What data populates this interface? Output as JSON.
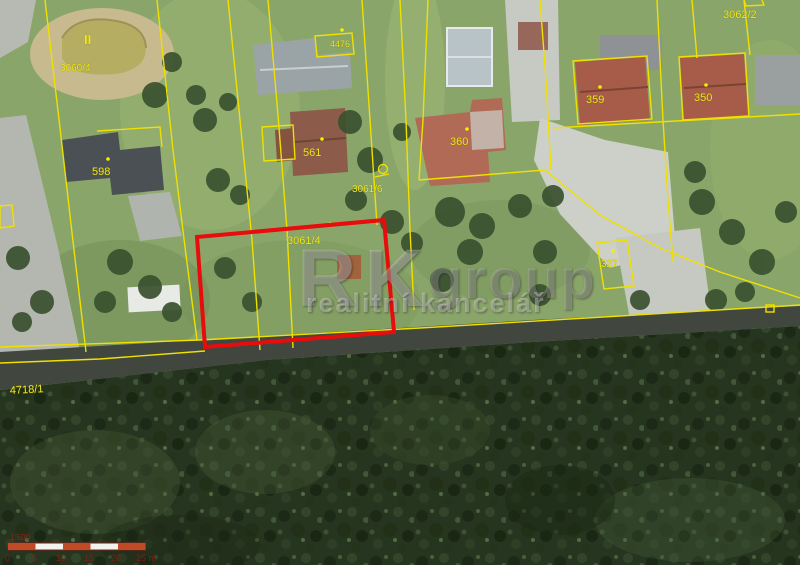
{
  "watermark": {
    "rk": "RK",
    "group": "group",
    "subtitle": "realitní kancelář"
  },
  "labels": {
    "pond_mark": "II",
    "parcel_pond": "3060/4",
    "parcel_top_mid": "4476",
    "house_598": "598",
    "house_561": "561",
    "house_360": "360",
    "house_359": "359",
    "house_350": "350",
    "parcel_327": "327",
    "parcel_3061_6": "3061/6",
    "parcel_3061_4": "3061/4",
    "parcel_3062_2": "3062/2",
    "road_4718_1": "4718/1"
  },
  "scalebar": {
    "ratio": "1:500",
    "ticks": [
      "0",
      "5",
      "10",
      "15",
      "20",
      "25 m"
    ]
  },
  "colors": {
    "cadastral_line": "#efe000",
    "cadastral_text": "#efe81c",
    "highlight_parcel": "#e80c0c",
    "road": "#41463f",
    "forest": "#26351f",
    "grass": "#8aa569",
    "scalebar_red": "#bf4a26",
    "scalebar_text": "#7a2015"
  }
}
